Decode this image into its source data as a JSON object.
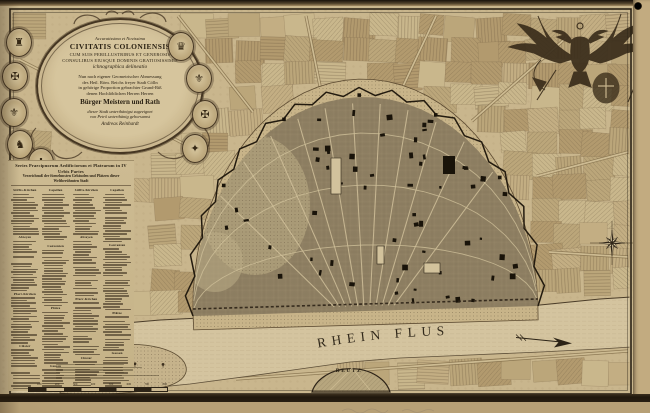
{
  "map": {
    "type": "Engraved 18th-century fortified city plan of Cologne on the Rhine",
    "river_label": "RHEIN FLUS",
    "village_label": "DEUTZ"
  },
  "cartouche": {
    "lines": [
      "Accuratissima et Novissima",
      "CIVITATIS COLONIENSIS",
      "cum suis perillustribus et generosis",
      "Consulibus eiusque Dominis gratiosissimis",
      "ichnographica delineatio",
      "Nun nach eigener Geometrischer Abmessung",
      "des Heil. Röm. Reichs freyer Stadt Cölln",
      "in gehörige Proportion gebrachter Grund-Riß",
      "denen Hochlöblichen Herren Herren",
      "Bürger Meistern und Rath",
      "dieser Stadt unterthänigst zugeeignet",
      "von Petrô unterthänig gehorsamst",
      "Andreas Reinhardt"
    ],
    "medallions": [
      "♜",
      "✠",
      "⚜",
      "♞",
      "✚",
      "♛",
      "⚜",
      "✠",
      "✦"
    ]
  },
  "legend": {
    "header_line1": "Series Praecipuorum Aedificiorum et Platearum in IV Urbis Partes",
    "header_line2": "Verzeichnuß der fürnehmsten Gebäuden und Plätzen dieser Weltberühmten Stadt",
    "sections": [
      "Stiffts-Kirchen",
      "Abteyen",
      "Pfarr-Kirchen",
      "Clöster",
      "Capellen",
      "Conventen",
      "Plätze",
      "Gassen"
    ],
    "entries_note": "micro-engraved index text, illegible at this resolution"
  },
  "scale_bar": {
    "tick_labels": [
      "100",
      "200",
      "300",
      "400",
      "500",
      "600",
      "700",
      "800"
    ]
  },
  "icons": {
    "compass": "compass-rose-icon",
    "flow_arrow": "river-flow-arrow-icon",
    "eagle": "double-headed-eagle-icon",
    "punch_hole": "punch-hole-dot"
  },
  "palette": {
    "paper": "#cbb890",
    "paper_margin": "#c0a97d",
    "ink": "#2c2316",
    "river": "#d4c49f",
    "city": "#a39372",
    "building": "#191309",
    "bottom_band": "#1f170d"
  }
}
